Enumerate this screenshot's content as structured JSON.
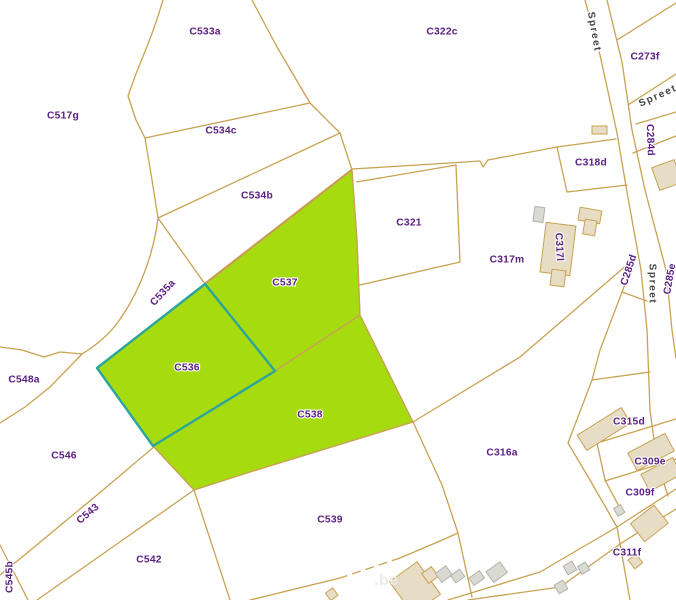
{
  "map": {
    "colors": {
      "background": "#ffffff",
      "parcel_line": "#c9a252",
      "highlight_fill": "#a6dc0f",
      "highlight_stroke": "#d08570",
      "selected_stroke": "#2ba59b",
      "parcel_label_color": "#5b2084",
      "street_label_color": "#454545",
      "building_fill": "#e7dcc4",
      "building_stroke": "#c9a252",
      "building_gray_fill": "#dadad2",
      "building_gray_stroke": "#b3b3ab",
      "watermark_color": "#ecece5"
    },
    "highlighted_parcels": [
      "C537",
      "C536",
      "C538"
    ],
    "selected_parcel": "C536",
    "parcel_labels": [
      {
        "text": "C533a",
        "x": 205,
        "y": 32,
        "rot": 0
      },
      {
        "text": "C322c",
        "x": 442,
        "y": 32,
        "rot": 0
      },
      {
        "text": "C273f",
        "x": 645,
        "y": 57,
        "rot": 0
      },
      {
        "text": "C517g",
        "x": 63,
        "y": 116,
        "rot": 0
      },
      {
        "text": "C534c",
        "x": 221,
        "y": 131,
        "rot": 0
      },
      {
        "text": "C284d",
        "x": 650,
        "y": 140,
        "rot": 88
      },
      {
        "text": "C318d",
        "x": 591,
        "y": 163,
        "rot": 0
      },
      {
        "text": "C534b",
        "x": 257,
        "y": 196,
        "rot": 0
      },
      {
        "text": "C321",
        "x": 409,
        "y": 223,
        "rot": 0
      },
      {
        "text": "C317l",
        "x": 559,
        "y": 247,
        "rot": 87
      },
      {
        "text": "C317m",
        "x": 507,
        "y": 260,
        "rot": 0
      },
      {
        "text": "C285d",
        "x": 629,
        "y": 270,
        "rot": -72
      },
      {
        "text": "C285e",
        "x": 670,
        "y": 279,
        "rot": -80
      },
      {
        "text": "C537",
        "x": 285,
        "y": 283,
        "rot": 0
      },
      {
        "text": "C535a",
        "x": 163,
        "y": 293,
        "rot": -47
      },
      {
        "text": "C536",
        "x": 187,
        "y": 368,
        "rot": 0
      },
      {
        "text": "C548a",
        "x": 24,
        "y": 380,
        "rot": 0
      },
      {
        "text": "C538",
        "x": 310,
        "y": 415,
        "rot": 0
      },
      {
        "text": "C315d",
        "x": 629,
        "y": 422,
        "rot": 0
      },
      {
        "text": "C316a",
        "x": 502,
        "y": 453,
        "rot": 0
      },
      {
        "text": "C546",
        "x": 64,
        "y": 456,
        "rot": 0
      },
      {
        "text": "C309e",
        "x": 650,
        "y": 462,
        "rot": 0
      },
      {
        "text": "C309f",
        "x": 640,
        "y": 493,
        "rot": 0
      },
      {
        "text": "C543",
        "x": 88,
        "y": 514,
        "rot": -40
      },
      {
        "text": "C539",
        "x": 330,
        "y": 520,
        "rot": 0
      },
      {
        "text": "C311f",
        "x": 627,
        "y": 553,
        "rot": 0
      },
      {
        "text": "C542",
        "x": 149,
        "y": 560,
        "rot": 0
      },
      {
        "text": "C545b",
        "x": 10,
        "y": 577,
        "rot": -90
      }
    ],
    "street_labels": [
      {
        "text": "Spreet",
        "x": 594,
        "y": 32,
        "rot": 80
      },
      {
        "text": "Spreet",
        "x": 658,
        "y": 96,
        "rot": -24
      },
      {
        "text": "Spreet",
        "x": 652,
        "y": 284,
        "rot": 90
      }
    ]
  },
  "watermark": {
    "text": ".be"
  }
}
